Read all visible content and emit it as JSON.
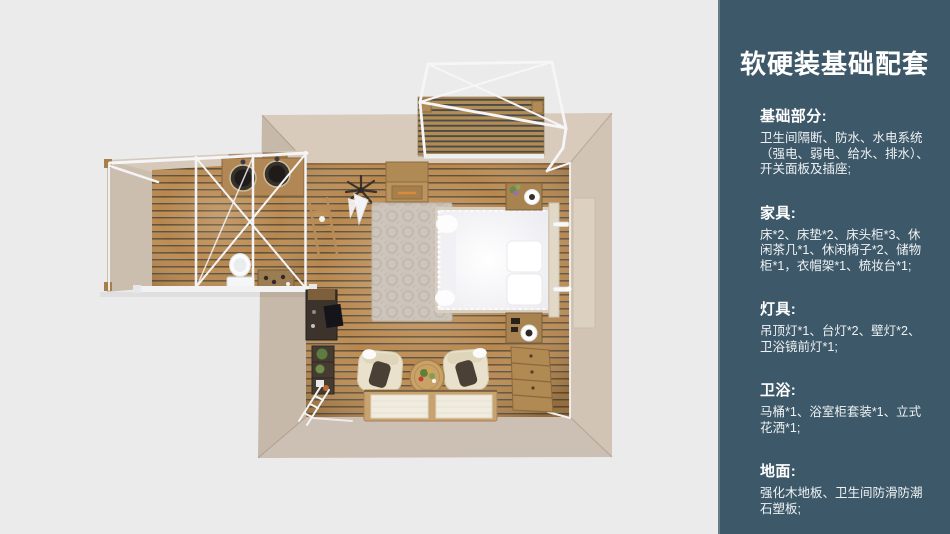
{
  "panel": {
    "background": "#3d5868",
    "text_color": "#ffffff",
    "title": "软硬装基础配套",
    "sections": [
      {
        "heading": "基础部分:",
        "body": "卫生间隔断、防水、水电系统\n（强电、弱电、给水、排水）、\n开关面板及插座;"
      },
      {
        "heading": "家具:",
        "body": "床*2、床垫*2、床头柜*3、休\n闲茶几*1、休闲椅子*2、储物\n柜*1，衣帽架*1、梳妆台*1;"
      },
      {
        "heading": "灯具:",
        "body": "吊顶灯*1、台灯*2、壁灯*2、\n卫浴镜前灯*1;"
      },
      {
        "heading": "卫浴:",
        "body": "马桶*1、浴室柜套装*1、立式\n花洒*1;"
      },
      {
        "heading": "地面:",
        "body": "强化木地板、卫生间防滑防潮\n石塑板;"
      }
    ]
  },
  "floor_plan": {
    "background": "#ebebeb",
    "colors": {
      "wall": "#d3c5b5",
      "wood_floor": "#b8874e",
      "deck_wood": "#b18c55",
      "frame_white": "#f5f5f7",
      "bed_white": "#f7f7f9",
      "rug": "#cdc5bb"
    },
    "items": [
      "balcony-deck",
      "pergola-frame",
      "bathroom-annex",
      "vanity-double-sinks",
      "toilet",
      "glass-partition",
      "towel-rack",
      "coat-rack",
      "storage-cabinet",
      "rug",
      "double-bed",
      "nightstand-top",
      "nightstand-bottom",
      "table-lamp",
      "wall-lamp",
      "dresser",
      "desk",
      "plant-shelf",
      "armchair-left",
      "armchair-right",
      "coffee-table",
      "floor-mats",
      "white-ladder"
    ]
  }
}
